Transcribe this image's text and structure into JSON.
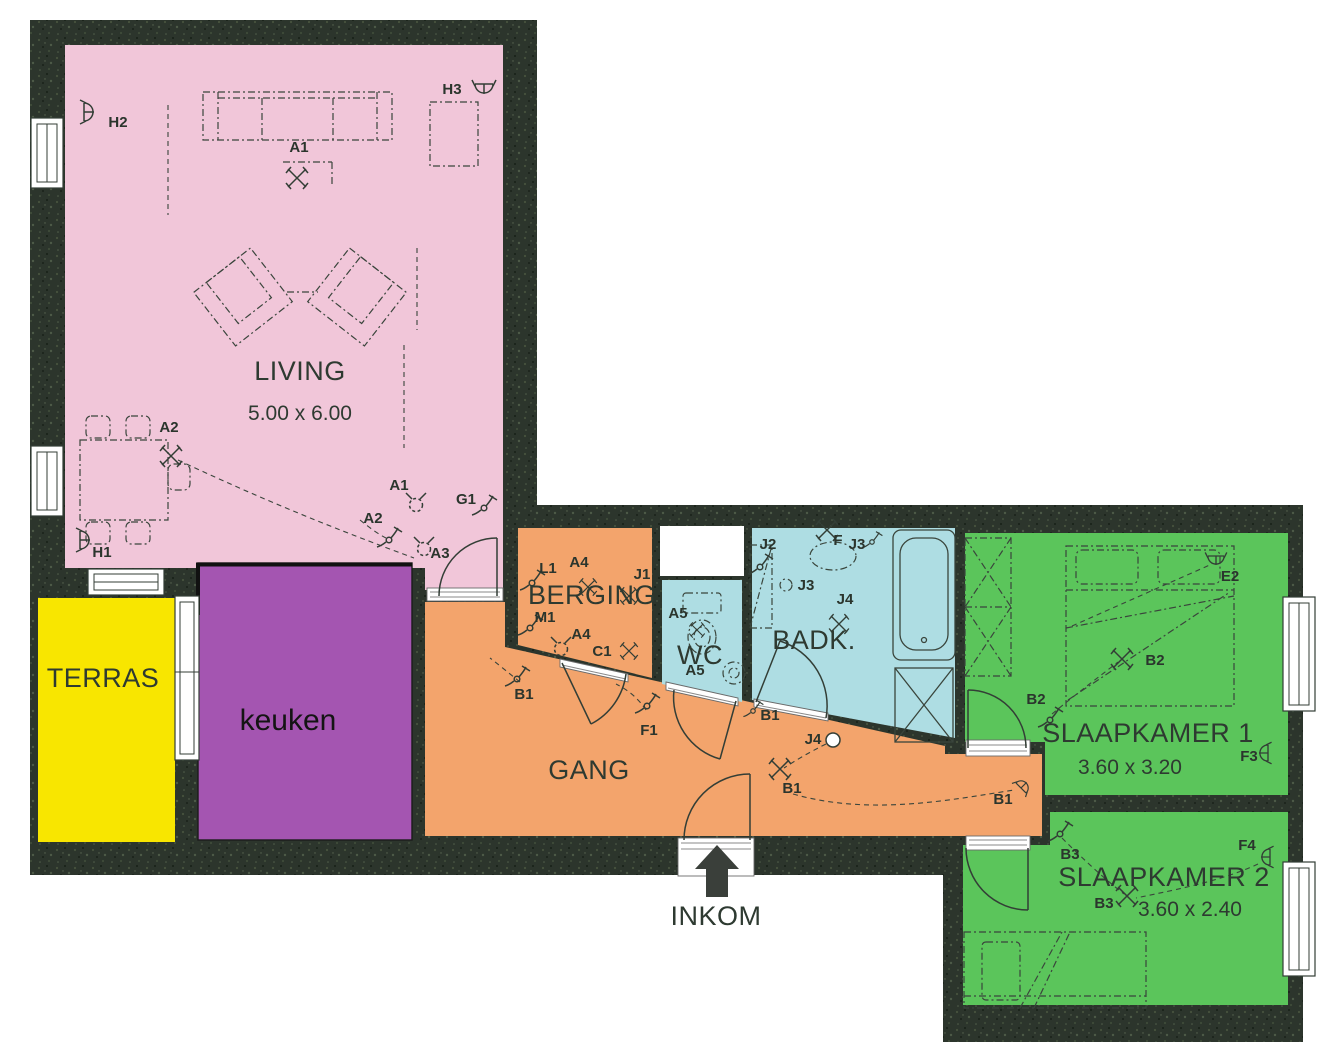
{
  "colors": {
    "wall": "#2c352c",
    "ink": "#333e36",
    "white": "#ffffff"
  },
  "rooms": [
    {
      "id": "living",
      "name": "LIVING",
      "dims": "5.00 x 6.00",
      "color": "#f1c6d9"
    },
    {
      "id": "terras",
      "name": "TERRAS",
      "color": "#f8e600"
    },
    {
      "id": "keuken",
      "name": "keuken",
      "color": "#a455b1"
    },
    {
      "id": "berging",
      "name": "BERGING",
      "color": "#f3a46c"
    },
    {
      "id": "gang",
      "name": "GANG",
      "color": "#f3a46c"
    },
    {
      "id": "wc",
      "name": "WC",
      "color": "#aedde3"
    },
    {
      "id": "badkamer",
      "name": "BADK.",
      "color": "#aedde3"
    },
    {
      "id": "slaapkamer1",
      "name": "SLAAPKAMER 1",
      "dims": "3.60 x 3.20",
      "color": "#5bc55b"
    },
    {
      "id": "slaapkamer2",
      "name": "SLAAPKAMER 2",
      "dims": "3.60 x 2.40",
      "color": "#5bc55b"
    }
  ],
  "entrance": {
    "label": "INKOM"
  },
  "symbols": [
    {
      "label": "H2",
      "type": "socket"
    },
    {
      "label": "H3",
      "type": "socket"
    },
    {
      "label": "A1",
      "type": "ceiling-light"
    },
    {
      "label": "A2",
      "type": "ceiling-light"
    },
    {
      "label": "H1",
      "type": "socket"
    },
    {
      "label": "A1",
      "type": "wall-light"
    },
    {
      "label": "G1",
      "type": "switch"
    },
    {
      "label": "A2",
      "type": "switch"
    },
    {
      "label": "A3",
      "type": "wall-light"
    },
    {
      "label": "L1",
      "type": "switch"
    },
    {
      "label": "A4",
      "type": "ceiling-light"
    },
    {
      "label": "J1",
      "type": "ceiling-light"
    },
    {
      "label": "M1",
      "type": "switch"
    },
    {
      "label": "A4",
      "type": "wall-light"
    },
    {
      "label": "C1",
      "type": "ceiling-light"
    },
    {
      "label": "A5",
      "type": "ceiling-light"
    },
    {
      "label": "A5",
      "type": "label"
    },
    {
      "label": "J2",
      "type": "switch"
    },
    {
      "label": "F",
      "type": "ceiling-light"
    },
    {
      "label": "J3",
      "type": "switch"
    },
    {
      "label": "J3",
      "type": "wall-light"
    },
    {
      "label": "J4",
      "type": "ceiling-light"
    },
    {
      "label": "B1",
      "type": "switch"
    },
    {
      "label": "F1",
      "type": "switch"
    },
    {
      "label": "B1",
      "type": "switch"
    },
    {
      "label": "J4",
      "type": "lamp"
    },
    {
      "label": "B1",
      "type": "ceiling-light"
    },
    {
      "label": "B1",
      "type": "socket"
    },
    {
      "label": "B2",
      "type": "ceiling-light"
    },
    {
      "label": "B2",
      "type": "switch"
    },
    {
      "label": "E2",
      "type": "socket"
    },
    {
      "label": "F3",
      "type": "socket"
    },
    {
      "label": "B3",
      "type": "switch"
    },
    {
      "label": "B3",
      "type": "ceiling-light"
    },
    {
      "label": "F4",
      "type": "socket"
    }
  ]
}
